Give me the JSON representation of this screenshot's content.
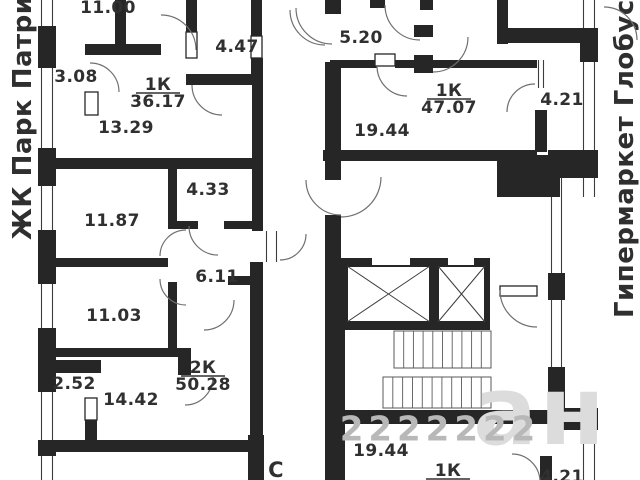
{
  "margin_labels": {
    "left": "ЖК Парк Патриот",
    "right": "Гипермаркет Глобус"
  },
  "compass": {
    "text": "С",
    "x": 276,
    "y": 471,
    "size": 21
  },
  "apartments": [
    {
      "type": "1К",
      "area": "36.17"
    },
    {
      "type": "1К",
      "area": "47.07"
    },
    {
      "type": "2К",
      "area": "50.28"
    },
    {
      "type": "1К",
      "area": ""
    }
  ],
  "plan": {
    "colors": {
      "wall": "#262626",
      "line": "#3c3c3c",
      "arc": "#707070",
      "stair": "#5a5a5a",
      "text": "#303030"
    },
    "room_labels": [
      {
        "text": "11.00",
        "x": 108,
        "y": 8
      },
      {
        "text": "4.47",
        "x": 237,
        "y": 47
      },
      {
        "text": "3.08",
        "x": 76,
        "y": 77
      },
      {
        "text": "13.29",
        "x": 126,
        "y": 128
      },
      {
        "text": "11.87",
        "x": 112,
        "y": 221
      },
      {
        "text": "4.33",
        "x": 208,
        "y": 190
      },
      {
        "text": "6.11",
        "x": 217,
        "y": 277
      },
      {
        "text": "11.03",
        "x": 114,
        "y": 316
      },
      {
        "text": "2.52",
        "x": 74,
        "y": 384
      },
      {
        "text": "14.42",
        "x": 131,
        "y": 400
      },
      {
        "text": "5.20",
        "x": 361,
        "y": 38
      },
      {
        "text": "19.44",
        "x": 382,
        "y": 131
      },
      {
        "text": "4.21",
        "x": 562,
        "y": 100
      },
      {
        "text": "19.44",
        "x": 381,
        "y": 451
      },
      {
        "text": "4.21",
        "x": 562,
        "y": 477
      }
    ],
    "apartment_labels": [
      {
        "type": "1К",
        "area": "36.17",
        "x": 158,
        "y": 85
      },
      {
        "type": "1К",
        "area": "47.07",
        "x": 449,
        "y": 91
      },
      {
        "type": "2К",
        "area": "50.28",
        "x": 203,
        "y": 368
      },
      {
        "type": "1К",
        "area": "",
        "x": 448,
        "y": 471
      }
    ],
    "windows": [
      {
        "x": 38,
        "y": 0,
        "w": 18,
        "h": 480,
        "dir": "v"
      },
      {
        "x": 580,
        "y": 0,
        "w": 18,
        "h": 197,
        "dir": "v"
      },
      {
        "x": 580,
        "y": 408,
        "w": 18,
        "h": 72,
        "dir": "v"
      },
      {
        "x": 548,
        "y": 178,
        "w": 17,
        "h": 235,
        "dir": "v"
      },
      {
        "x": 535,
        "y": 60,
        "w": 12,
        "h": 28,
        "dir": "v"
      },
      {
        "x": 263,
        "y": 231,
        "w": 17,
        "h": 31,
        "dir": "v"
      }
    ],
    "walls": [
      {
        "x": 38,
        "y": 26,
        "w": 18,
        "h": 42
      },
      {
        "x": 38,
        "y": 148,
        "w": 18,
        "h": 38
      },
      {
        "x": 38,
        "y": 230,
        "w": 18,
        "h": 54
      },
      {
        "x": 38,
        "y": 328,
        "w": 18,
        "h": 64
      },
      {
        "x": 38,
        "y": 440,
        "w": 18,
        "h": 16
      },
      {
        "x": 115,
        "y": 0,
        "w": 11,
        "h": 55
      },
      {
        "x": 85,
        "y": 44,
        "w": 76,
        "h": 11
      },
      {
        "x": 186,
        "y": 0,
        "w": 11,
        "h": 32
      },
      {
        "x": 186,
        "y": 74,
        "w": 77,
        "h": 11
      },
      {
        "x": 251,
        "y": 0,
        "w": 11,
        "h": 36
      },
      {
        "x": 251,
        "y": 58,
        "w": 12,
        "h": 16
      },
      {
        "x": 252,
        "y": 74,
        "w": 11,
        "h": 95
      },
      {
        "x": 38,
        "y": 158,
        "w": 225,
        "h": 11
      },
      {
        "x": 168,
        "y": 169,
        "w": 9,
        "h": 60
      },
      {
        "x": 168,
        "y": 221,
        "w": 30,
        "h": 8
      },
      {
        "x": 224,
        "y": 221,
        "w": 28,
        "h": 8
      },
      {
        "x": 38,
        "y": 258,
        "w": 130,
        "h": 9
      },
      {
        "x": 168,
        "y": 282,
        "w": 9,
        "h": 66
      },
      {
        "x": 252,
        "y": 169,
        "w": 11,
        "h": 62
      },
      {
        "x": 250,
        "y": 262,
        "w": 13,
        "h": 178
      },
      {
        "x": 228,
        "y": 276,
        "w": 35,
        "h": 9
      },
      {
        "x": 38,
        "y": 348,
        "w": 153,
        "h": 9
      },
      {
        "x": 178,
        "y": 348,
        "w": 13,
        "h": 27
      },
      {
        "x": 56,
        "y": 360,
        "w": 45,
        "h": 13
      },
      {
        "x": 85,
        "y": 420,
        "w": 12,
        "h": 20
      },
      {
        "x": 38,
        "y": 440,
        "w": 216,
        "h": 12
      },
      {
        "x": 248,
        "y": 435,
        "w": 16,
        "h": 45
      },
      {
        "x": 325,
        "y": 0,
        "w": 16,
        "h": 14
      },
      {
        "x": 325,
        "y": 62,
        "w": 16,
        "h": 118
      },
      {
        "x": 325,
        "y": 215,
        "w": 16,
        "h": 48
      },
      {
        "x": 325,
        "y": 260,
        "w": 20,
        "h": 152
      },
      {
        "x": 325,
        "y": 410,
        "w": 20,
        "h": 70
      },
      {
        "x": 370,
        "y": 0,
        "w": 15,
        "h": 8
      },
      {
        "x": 420,
        "y": 0,
        "w": 13,
        "h": 10
      },
      {
        "x": 414,
        "y": 25,
        "w": 19,
        "h": 12
      },
      {
        "x": 414,
        "y": 55,
        "w": 19,
        "h": 18
      },
      {
        "x": 330,
        "y": 60,
        "w": 47,
        "h": 8
      },
      {
        "x": 395,
        "y": 60,
        "w": 142,
        "h": 8
      },
      {
        "x": 497,
        "y": 0,
        "w": 11,
        "h": 44
      },
      {
        "x": 497,
        "y": 28,
        "w": 101,
        "h": 15
      },
      {
        "x": 535,
        "y": 110,
        "w": 12,
        "h": 42
      },
      {
        "x": 323,
        "y": 150,
        "w": 214,
        "h": 11
      },
      {
        "x": 497,
        "y": 155,
        "w": 63,
        "h": 42
      },
      {
        "x": 548,
        "y": 150,
        "w": 50,
        "h": 28
      },
      {
        "x": 548,
        "y": 273,
        "w": 17,
        "h": 27
      },
      {
        "x": 548,
        "y": 367,
        "w": 17,
        "h": 46
      },
      {
        "x": 548,
        "y": 408,
        "w": 50,
        "h": 22
      },
      {
        "x": 580,
        "y": 30,
        "w": 18,
        "h": 32
      },
      {
        "x": 325,
        "y": 410,
        "w": 235,
        "h": 14
      },
      {
        "x": 540,
        "y": 456,
        "w": 12,
        "h": 24
      }
    ],
    "door_leaves": [
      {
        "x": 85,
        "y": 92,
        "w": 13,
        "h": 23
      },
      {
        "x": 85,
        "y": 398,
        "w": 12,
        "h": 22
      },
      {
        "x": 186,
        "y": 32,
        "w": 11,
        "h": 26
      },
      {
        "x": 251,
        "y": 36,
        "w": 11,
        "h": 22
      },
      {
        "x": 375,
        "y": 54,
        "w": 20,
        "h": 12
      },
      {
        "x": 500,
        "y": 286,
        "w": 37,
        "h": 10
      }
    ],
    "door_arcs": [
      {
        "cx": 161,
        "cy": 50,
        "r": 35,
        "a1": -90,
        "a2": 0
      },
      {
        "cx": 325,
        "cy": 10,
        "r": 35,
        "a1": 90,
        "a2": 180
      },
      {
        "cx": 222,
        "cy": 85,
        "r": 30,
        "a1": 90,
        "a2": 180
      },
      {
        "cx": 90,
        "cy": 92,
        "r": 29,
        "a1": -90,
        "a2": 0
      },
      {
        "cx": 218,
        "cy": 226,
        "r": 29,
        "a1": 90,
        "a2": 180
      },
      {
        "cx": 280,
        "cy": 234,
        "r": 26,
        "a1": 0,
        "a2": 90
      },
      {
        "cx": 186,
        "cy": 256,
        "r": 26,
        "a1": 180,
        "a2": 270
      },
      {
        "cx": 186,
        "cy": 279,
        "r": 26,
        "a1": 90,
        "a2": 180
      },
      {
        "cx": 185,
        "cy": 377,
        "r": 28,
        "a1": 0,
        "a2": 90
      },
      {
        "cx": 204,
        "cy": 300,
        "r": 30,
        "a1": 0,
        "a2": 90
      },
      {
        "cx": 420,
        "cy": 5,
        "r": 35,
        "a1": 90,
        "a2": 180
      },
      {
        "cx": 433,
        "cy": 37,
        "r": 35,
        "a1": 0,
        "a2": 90
      },
      {
        "cx": 407,
        "cy": 66,
        "r": 30,
        "a1": 90,
        "a2": 180
      },
      {
        "cx": 535,
        "cy": 112,
        "r": 28,
        "a1": 180,
        "a2": 270
      },
      {
        "cx": 341,
        "cy": 180,
        "r": 35,
        "a1": 90,
        "a2": 180
      },
      {
        "cx": 341,
        "cy": 177,
        "r": 40,
        "a1": 0,
        "a2": 90
      },
      {
        "cx": 537,
        "cy": 290,
        "r": 37,
        "a1": 90,
        "a2": 180
      },
      {
        "cx": 512,
        "cy": 482,
        "r": 28,
        "a1": -90,
        "a2": 0
      },
      {
        "cx": 332,
        "cy": 8,
        "r": 36,
        "a1": 90,
        "a2": 180
      },
      {
        "cx": 604,
        "cy": 40,
        "r": 33,
        "a1": -90,
        "a2": 0
      }
    ],
    "elevator": {
      "outer": {
        "x": 337,
        "y": 258,
        "w": 153,
        "h": 72
      },
      "gaps": [
        {
          "x": 372,
          "y": 258,
          "w": 38,
          "h": 8
        },
        {
          "x": 448,
          "y": 258,
          "w": 26,
          "h": 8
        }
      ],
      "cars": [
        {
          "x": 347,
          "y": 266,
          "w": 83,
          "h": 56
        },
        {
          "x": 438,
          "y": 266,
          "w": 47,
          "h": 56
        }
      ]
    },
    "stairs": [
      {
        "x": 394,
        "y": 331,
        "w": 97,
        "h": 37,
        "steps": 10
      },
      {
        "x": 383,
        "y": 377,
        "w": 108,
        "h": 31,
        "steps": 11
      }
    ],
    "watermarks": [
      {
        "text": "ан",
        "x": 540,
        "y": 418,
        "size": 95,
        "fill": "#dcdcdc",
        "spacing": 2
      },
      {
        "text": "2222222",
        "x": 440,
        "y": 431,
        "size": 34,
        "fill": "#b8b8b8",
        "spacing": 5
      }
    ]
  }
}
